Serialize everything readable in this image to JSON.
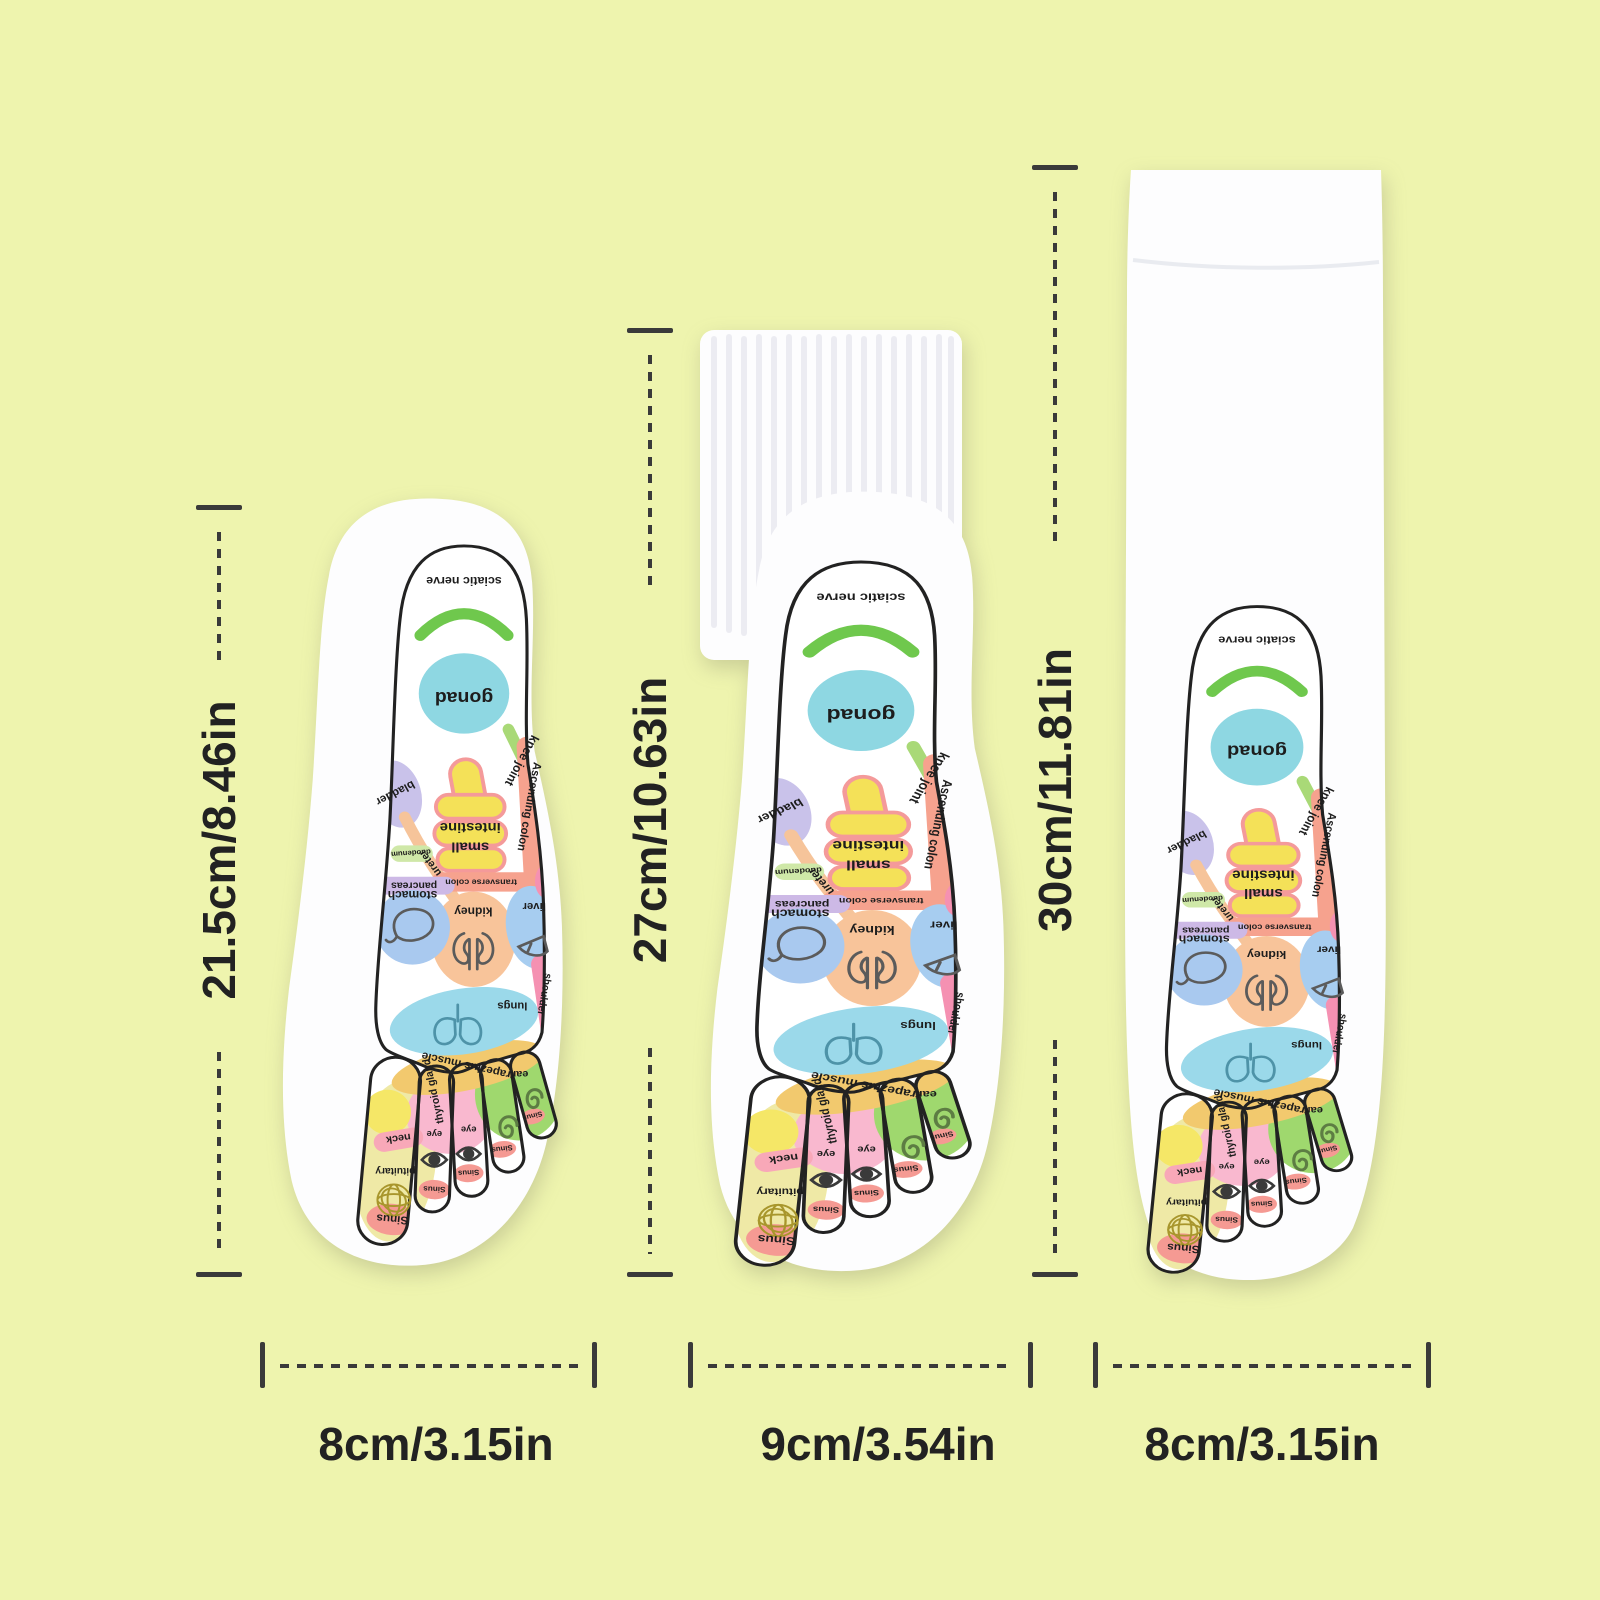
{
  "page": {
    "background_color": "#eef4ae",
    "annotation_color": "#3a3a3a"
  },
  "dimensions": {
    "left": {
      "height": "21.5cm/8.46in",
      "width": "8cm/3.15in"
    },
    "middle": {
      "height": "27cm/10.63in",
      "width": "9cm/3.54in"
    },
    "right": {
      "height": "30cm/11.81in",
      "width": "8cm/3.15in"
    }
  },
  "footprint": {
    "labels": {
      "sciatic_nerve": "sciatic nerve",
      "gonad": "gonad",
      "knee_joint": "knee joint",
      "bladder": "bladder",
      "ureter": "ureter",
      "small_intestine_line1": "small",
      "small_intestine_line2": "intestine",
      "ascending_colon": "Ascending colon",
      "transverse_colon": "transverse colon",
      "duodenum": "duodenum",
      "pancreas": "pancreas",
      "stomach": "stomach",
      "kidney": "kidney",
      "liver": "liver",
      "shoulder": "shoulder",
      "lungs": "lungs",
      "trapezius_muscle": "trapezius muscle",
      "thyroid_gland": "thyroid gland",
      "neck": "neck",
      "pituitary": "pituitary",
      "eye": "eye",
      "ear": "ear",
      "sinus": "Sinus"
    },
    "colors": {
      "outline": "#222222",
      "sciatic_nerve": "#6fc84d",
      "knee_joint_band": "#a9d977",
      "gonad": "#8ed7e2",
      "bladder": "#c9c2ea",
      "ureter": "#f6c49a",
      "small_intestine_fill": "#f4e158",
      "small_intestine_stroke": "#f49a9a",
      "colon": "#f6a28e",
      "duodenum": "#cfe8a8",
      "pancreas": "#cdb9e6",
      "stomach": "#a9c9ef",
      "kidney": "#f8c49a",
      "liver": "#a7cdf0",
      "shoulder": "#f591b2",
      "lungs": "#9bd9ea",
      "trapezius": "#f2c96e",
      "thyroid_circle": "#f5e767",
      "big_toe_zone": "#efe9a6",
      "neck_band": "#f8a8b8",
      "eye_zone": "#f9b8cf",
      "ear_zone": "#9fd86e",
      "sinus_fill": "#f59a93"
    }
  }
}
